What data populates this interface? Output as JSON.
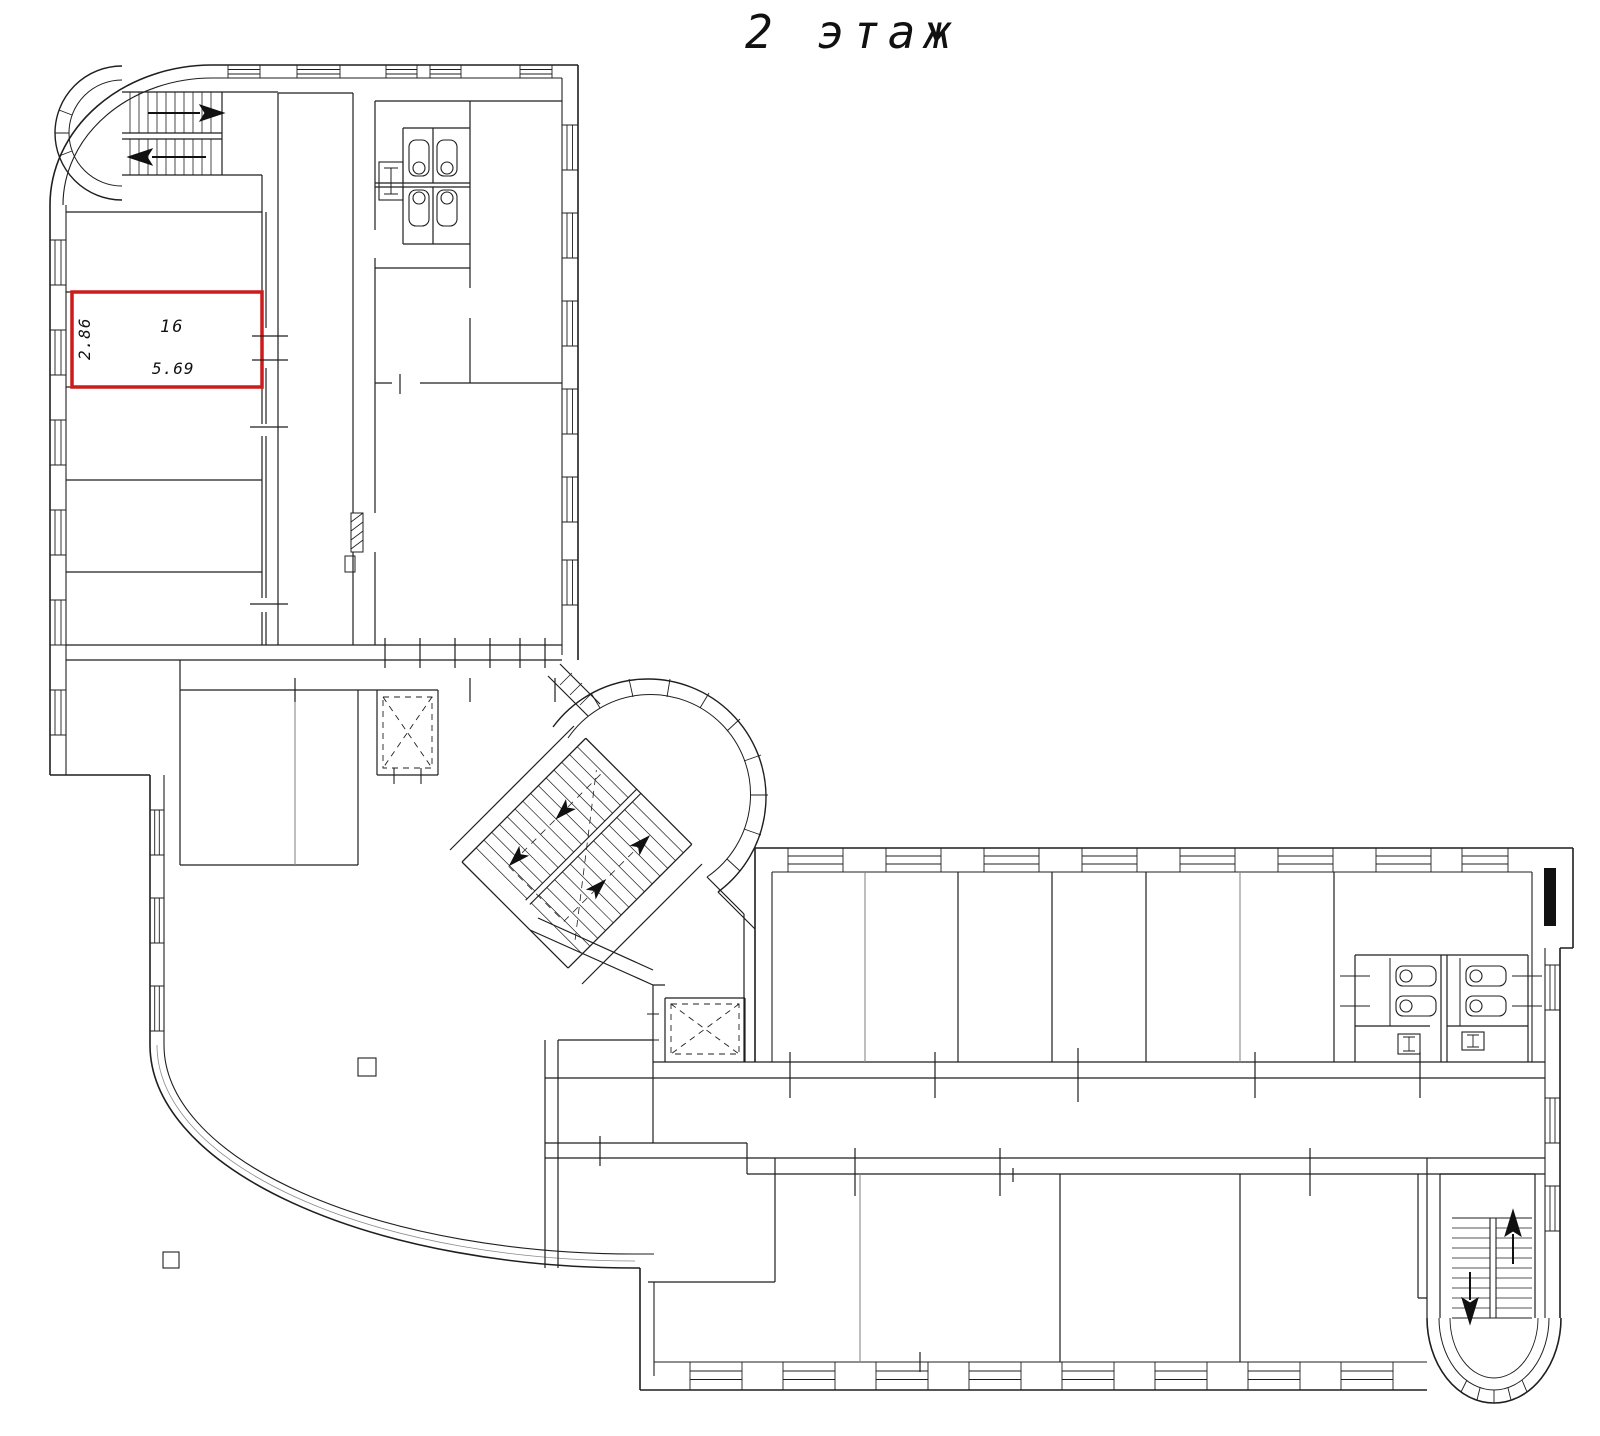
{
  "title": "2 этаж",
  "highlighted_room": {
    "number": "16",
    "width_m": "5.69",
    "depth_m": "2.86",
    "outline_color": "#cc1c1c"
  },
  "drawing": {
    "line_color": "#1f1f1f",
    "muted_line_color": "#8a8a8a",
    "background_color": "#ffffff"
  }
}
